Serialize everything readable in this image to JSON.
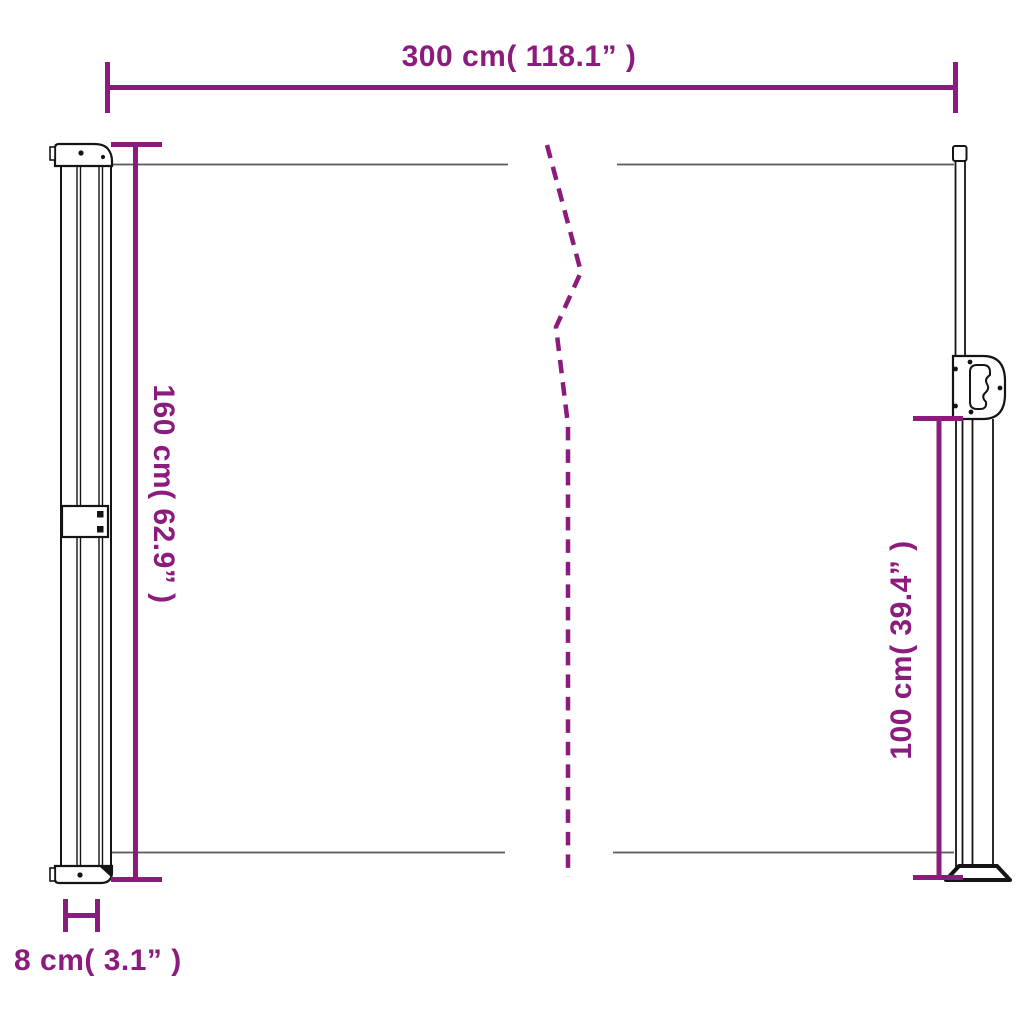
{
  "diagram": {
    "colors": {
      "dimension": "#8b1b7d",
      "outline": "#141414",
      "fabric": "#595959"
    },
    "labels": {
      "width_top": "300 cm( 118.1” )",
      "height_left": "160 cm( 62.9” )",
      "height_right": "100 cm( 39.4” )",
      "depth_bottom": "8 cm( 3.1” )"
    }
  }
}
